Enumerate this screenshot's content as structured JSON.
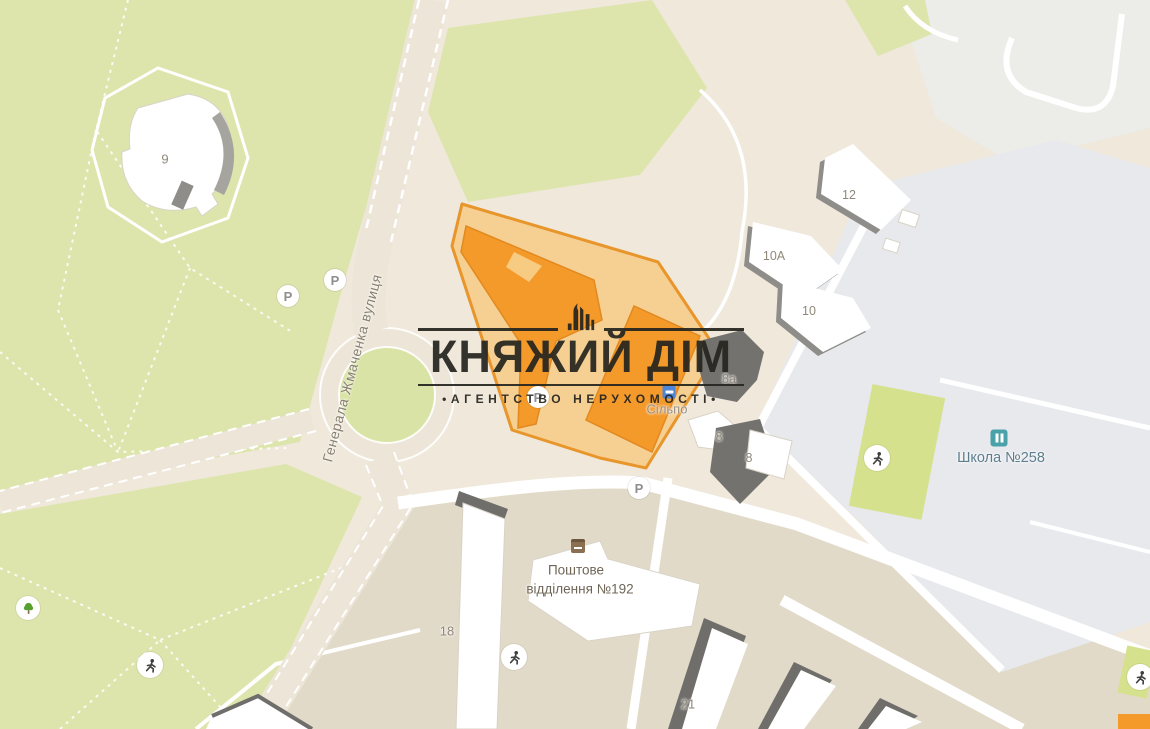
{
  "map": {
    "watermark": {
      "title": "КНЯЖИЙ ДІМ",
      "subtitle": "•АГЕНТСТВО НЕРУХОМОСТІ•"
    },
    "street_label": "Генерала Жмаченка вулиця",
    "pois": {
      "school": {
        "label": "Школа №258"
      },
      "supermarket": {
        "label": "Сільпо"
      },
      "post_office": {
        "label_line1": "Поштове",
        "label_line2": "відділення №192"
      }
    },
    "building_labels": [
      {
        "label": "9"
      },
      {
        "label": "12"
      },
      {
        "label": "10А"
      },
      {
        "label": "10"
      },
      {
        "label": "8а"
      },
      {
        "label": "8"
      },
      {
        "label": "8"
      },
      {
        "label": "18"
      },
      {
        "label": "21"
      }
    ],
    "icons": {
      "parking_letter": "P"
    },
    "colors": {
      "map_base": "#EFE8DB",
      "park_green": "#DDE5AC",
      "sports_field_green": "#D6E18E",
      "school_area_gray": "#E7E9ED",
      "highlight_building_orange": "#F49A2B",
      "highlight_parcel_fill": "#F8CB83",
      "highlight_parcel_border": "#E8962B",
      "watermark_black": "#26251F"
    }
  }
}
